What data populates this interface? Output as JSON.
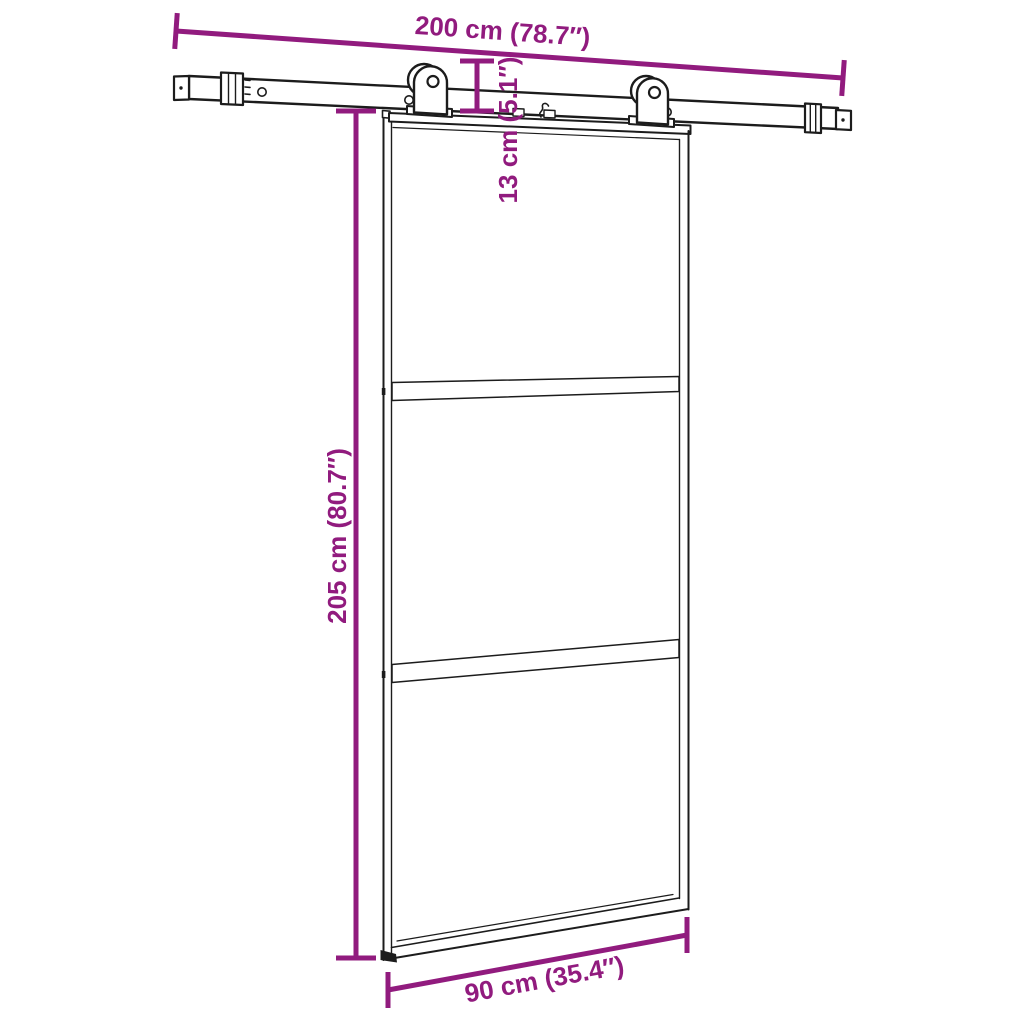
{
  "page": {
    "title": "Sliding door with hardware set - dimension diagram",
    "background": "#ffffff"
  },
  "diagram": {
    "type": "product-dimension-diagram",
    "subject": "sliding glass door with three panels hanging from a top rail by two roller hangers",
    "colors": {
      "dimension": "#911b7e",
      "line": "#1c1c1c",
      "background": "#ffffff"
    },
    "dimensions": {
      "rail_length": {
        "label": "200 cm (78.7″)",
        "placement": "top, along the sliding rail"
      },
      "hanger_drop": {
        "label": "13 cm (5.1″)",
        "placement": "vertical, between rail and door top"
      },
      "door_height": {
        "label": "205 cm (80.7″)",
        "placement": "left side, full door height"
      },
      "door_width": {
        "label": "90 cm (35.4″)",
        "placement": "bottom, along the door bottom edge"
      }
    }
  }
}
